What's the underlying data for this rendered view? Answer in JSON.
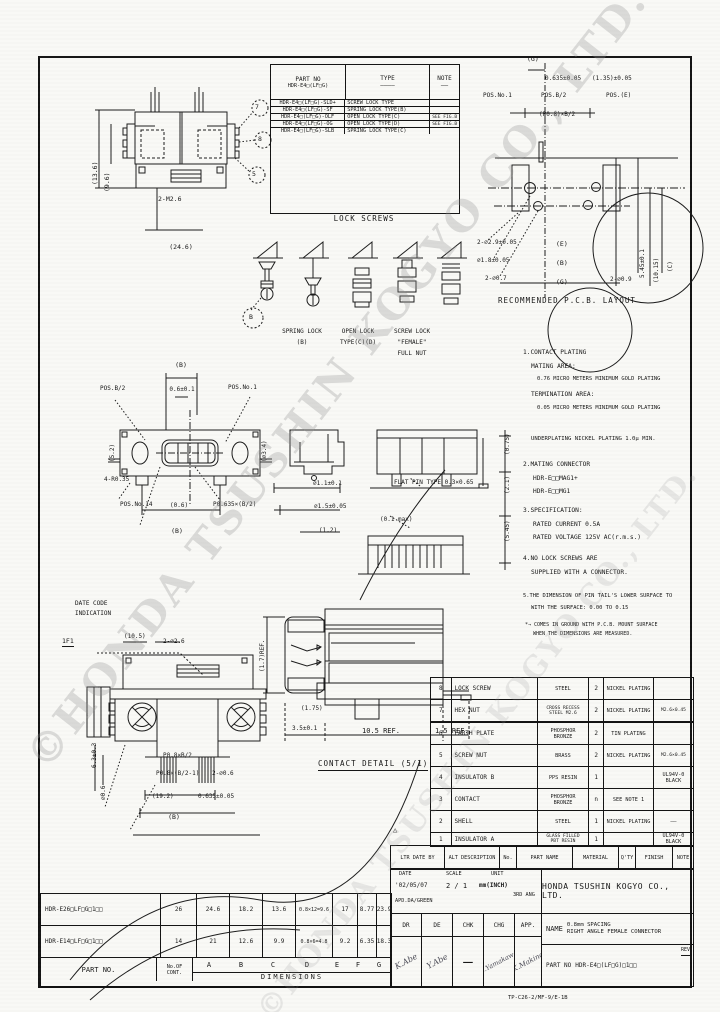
{
  "watermark": {
    "text": "©HONDA TSUSHIN KOGYO CO., LTD.",
    "text2": "©HONDA TSUSHIN KOGYO CO., LTD."
  },
  "lock_table": {
    "h_part": "PART NO",
    "h_part2": "HDR-E4□(LF□G)",
    "h_type": "TYPE",
    "h_note": "NOTE",
    "dash_type": "————",
    "dash_note": "——",
    "caption": "LOCK SCREWS",
    "rows": [
      {
        "part": "HDR-E4□(LF□G)-SLD+",
        "type": "SCREW LOCK TYPE",
        "note": ""
      },
      {
        "part": "HDR-E4□(LF□G)-SF",
        "type": "SPRING LOCK TYPE(B)",
        "note": ""
      },
      {
        "part": "HDR-E4□(LF□G)-OLF",
        "type": "OPEN LOCK TYPE(C)",
        "note": "SEE FIG.B"
      },
      {
        "part": "HDR-E4□(LF□G)-OG",
        "type": "OPEN LOCK TYPE(D)",
        "note": "SEE FIG.B"
      },
      {
        "part": "HDR-E4□(LF□G)-SLB",
        "type": "SPRING LOCK TYPE(C)",
        "note": ""
      }
    ]
  },
  "topview": {
    "bubble1": "7",
    "bubble2": "8",
    "bubble3": "5",
    "dim_a": "(24.6)",
    "dim_b": "2-M2.6",
    "side1": "(13.6)",
    "side2": "(9.6)"
  },
  "pcb": {
    "caption": "RECOMMENDED P.C.B. LAYOUT",
    "g_top": "(G)",
    "p1": "0.635±0.05",
    "p2": "(1.35)±0.05",
    "pos1": "POS.No.1",
    "posb": "POS.B/2",
    "pose": "POS.(E)",
    "p08": "(P0.8)×B/2",
    "d1": "2-⌀2.9±0.05",
    "d2": "⌀1.8±0.05",
    "d3": "2-⌀0.7",
    "e": "(E)",
    "b": "(B)",
    "g": "(G)",
    "d4": "2-⌀0.9",
    "r1": "5.45±0.1",
    "r2": "(10.15)",
    "r3": "(C)"
  },
  "screwfigs": {
    "bubble": "B",
    "c1a": "SPRING LOCK",
    "c1b": "(B)",
    "c2a": "OPEN LOCK",
    "c2b": "TYPE(C)(D)",
    "c3a": "SCREW LOCK",
    "c3b": "\"FEMALE\"",
    "c3c": "FULL NUT"
  },
  "front": {
    "b_top": "(B)",
    "t06": "0.6±0.1",
    "posb": "POS.B/2",
    "pos1": "POS.No.1",
    "r035": "4-R0.35",
    "pos14": "POS.No.14",
    "c06": "(0.6)",
    "p0635": "P0.635×(B/2)",
    "b_bot": "(B)",
    "side_l": "(5.2)",
    "side_r": "(⌀3.4)"
  },
  "sideview": {
    "d11": "⌀1.1±0.1",
    "d15": "⌀1.5±0.05",
    "d12": "(1.2)",
    "flat": "FLAT PIN TYPE 0.3×0.65",
    "max": "(0.1 max)",
    "v1": "(0.75)",
    "v2": "(2.1)",
    "v3": "(5.45)"
  },
  "notes": {
    "n01": "1.CONTACT PLATING",
    "n02": "MATING AREA:",
    "n03": "0.76 MICRO METERS MINIMUM GOLD PLATING",
    "n04": "TERMINATION AREA:",
    "n05": "0.05 MICRO METERS MINIMUM GOLD PLATING",
    "n06": "UNDERPLATING NICKEL PLATING 1.0μ MIN.",
    "n07": "2.MATING CONNECTOR",
    "n08": "HDR-E□□MAG1+",
    "n09": "HDR-E□□MG1",
    "n10": "3.SPECIFICATION:",
    "n11": "RATED CURRENT 0.5A",
    "n12": "RATED VOLTAGE 125V AC(r.m.s.)",
    "n13": "4.NO LOCK SCREWS ARE",
    "n14": "SUPPLIED WITH A CONNECTOR.",
    "n15": "5.THE DIMENSION OF PIN TAIL'S LOWER SURFACE TO",
    "n16": "WITH THE SURFACE: 0.00 TO 0.15",
    "n17": "*→ COMES IN GROUND WITH P.C.B. MOUNT SURFACE",
    "n18": "WHEN THE DIMENSIONS ARE MEASURED."
  },
  "datecode": {
    "l1": "DATE CODE",
    "l2": "INDICATION",
    "code": "1F1"
  },
  "rear": {
    "top1": "(10.5)",
    "top2": "2-⌀2.6",
    "p08a": "P0.8×B/2",
    "p08b": "P0.8×(B/2-1)",
    "d06": "2-⌀0.6",
    "d192": "(19.2)",
    "d0635": "0.635±0.05",
    "b": "(B)",
    "l1": "6.3±0.3",
    "l2": "⌀0.6"
  },
  "contact": {
    "caption": "CONTACT DETAIL (5/1)",
    "d35": "3.5±0.1",
    "d105": "10.5 REF.",
    "d15": "1.5 REF.",
    "d175": "(1.75)",
    "dv": "(1.7)REF."
  },
  "parts": {
    "rows": [
      {
        "no": "8",
        "name": "LOCK SCREW",
        "mat": "STEEL",
        "mat2": "",
        "qty": "2",
        "fin": "NICKEL PLATING",
        "note": ""
      },
      {
        "no": "7",
        "name": "HEX NUT",
        "mat": "CROSS RECESS",
        "mat2": "STEEL M2.6",
        "qty": "2",
        "fin": "NICKEL PLATING",
        "note": "M2.6×0.45"
      },
      {
        "no": "6",
        "name": "EARTH PLATE",
        "mat": "PHOSPHOR",
        "mat2": "BRONZE",
        "qty": "2",
        "fin": "TIN PLATING",
        "note": ""
      },
      {
        "no": "5",
        "name": "SCREW NUT",
        "mat": "BRASS",
        "mat2": "",
        "qty": "2",
        "fin": "NICKEL PLATING",
        "note": "M2.6×0.45"
      },
      {
        "no": "4",
        "name": "INSULATOR B",
        "mat": "PPS RESIN",
        "mat2": "",
        "qty": "1",
        "fin": "",
        "note": "UL94V-0 BLACK"
      },
      {
        "no": "3",
        "name": "CONTACT",
        "mat": "PHOSPHOR",
        "mat2": "BRONZE",
        "qty": "n",
        "fin": "SEE NOTE 1",
        "note": ""
      },
      {
        "no": "2",
        "name": "SHELL",
        "mat": "STEEL",
        "mat2": "",
        "qty": "1",
        "fin": "NICKEL PLATING",
        "note": "——"
      },
      {
        "no": "1",
        "name": "INSULATOR A",
        "mat": "GLASS FILLED",
        "mat2": "PBT RESIN",
        "qty": "1",
        "fin": "",
        "note": "UL94V-0 BLACK"
      }
    ]
  },
  "strip": {
    "ltr": "LTR DATE BY",
    "alt": "ALT DESCRIPTION",
    "no": "No.",
    "pname": "PART NAME",
    "mat": "MATERIAL",
    "qty": "Q'TY",
    "fin": "FINISH",
    "note": "NOTE",
    "rev_mark": "△"
  },
  "tb": {
    "date_h": "DATE",
    "scale_h": "SCALE",
    "unit_h": "UNIT",
    "date": "'02/05/07",
    "scale": "2 / 1",
    "unit": "mm(INCH)",
    "proj": "3RD ANG",
    "sub": "APD.DA/GREEN",
    "dr": "DR",
    "de": "DE",
    "chk": "CHK",
    "chg": "CHG",
    "app": "APP.",
    "sig1": "K.Abe",
    "sig2": "Y.Abe",
    "sig3": "—",
    "sig4": "S.Yamakawa",
    "sig5": "K.Makino",
    "company": "HONDA TSUSHIN KOGYO CO., LTD.",
    "name_h": "NAME",
    "name1": "0.8mm SPACING",
    "name2": "RIGHT ANGLE FEMALE CONNECTOR",
    "pn_h": "PART NO",
    "pn": "HDR-E4□(LF□G)□1□□",
    "rev": "REV"
  },
  "dims": {
    "part_h": "PART NO.",
    "cont1": "No.OF",
    "cont2": "CONT.",
    "A": "A",
    "B": "B",
    "C": "C",
    "D": "D",
    "E": "E",
    "F": "F",
    "G": "G",
    "dim_label": "DIMENSIONS",
    "rows": [
      {
        "part": "HDR-E26□LF□G□1□□",
        "n": "26",
        "a": "24.6",
        "b": "18.2",
        "c": "13.6",
        "d": "0.8×12=9.6",
        "e": "17",
        "f": "8.77",
        "g": "23.9"
      },
      {
        "part": "HDR-E14□LF□G□1□□",
        "n": "14",
        "a": "21",
        "b": "12.6",
        "c": "9.9",
        "d": "0.8×6=4.8",
        "e": "9.2",
        "f": "6.35",
        "g": "18.3"
      }
    ]
  },
  "footer": {
    "code": "TP-C26-2/MF-9/E-1B"
  }
}
